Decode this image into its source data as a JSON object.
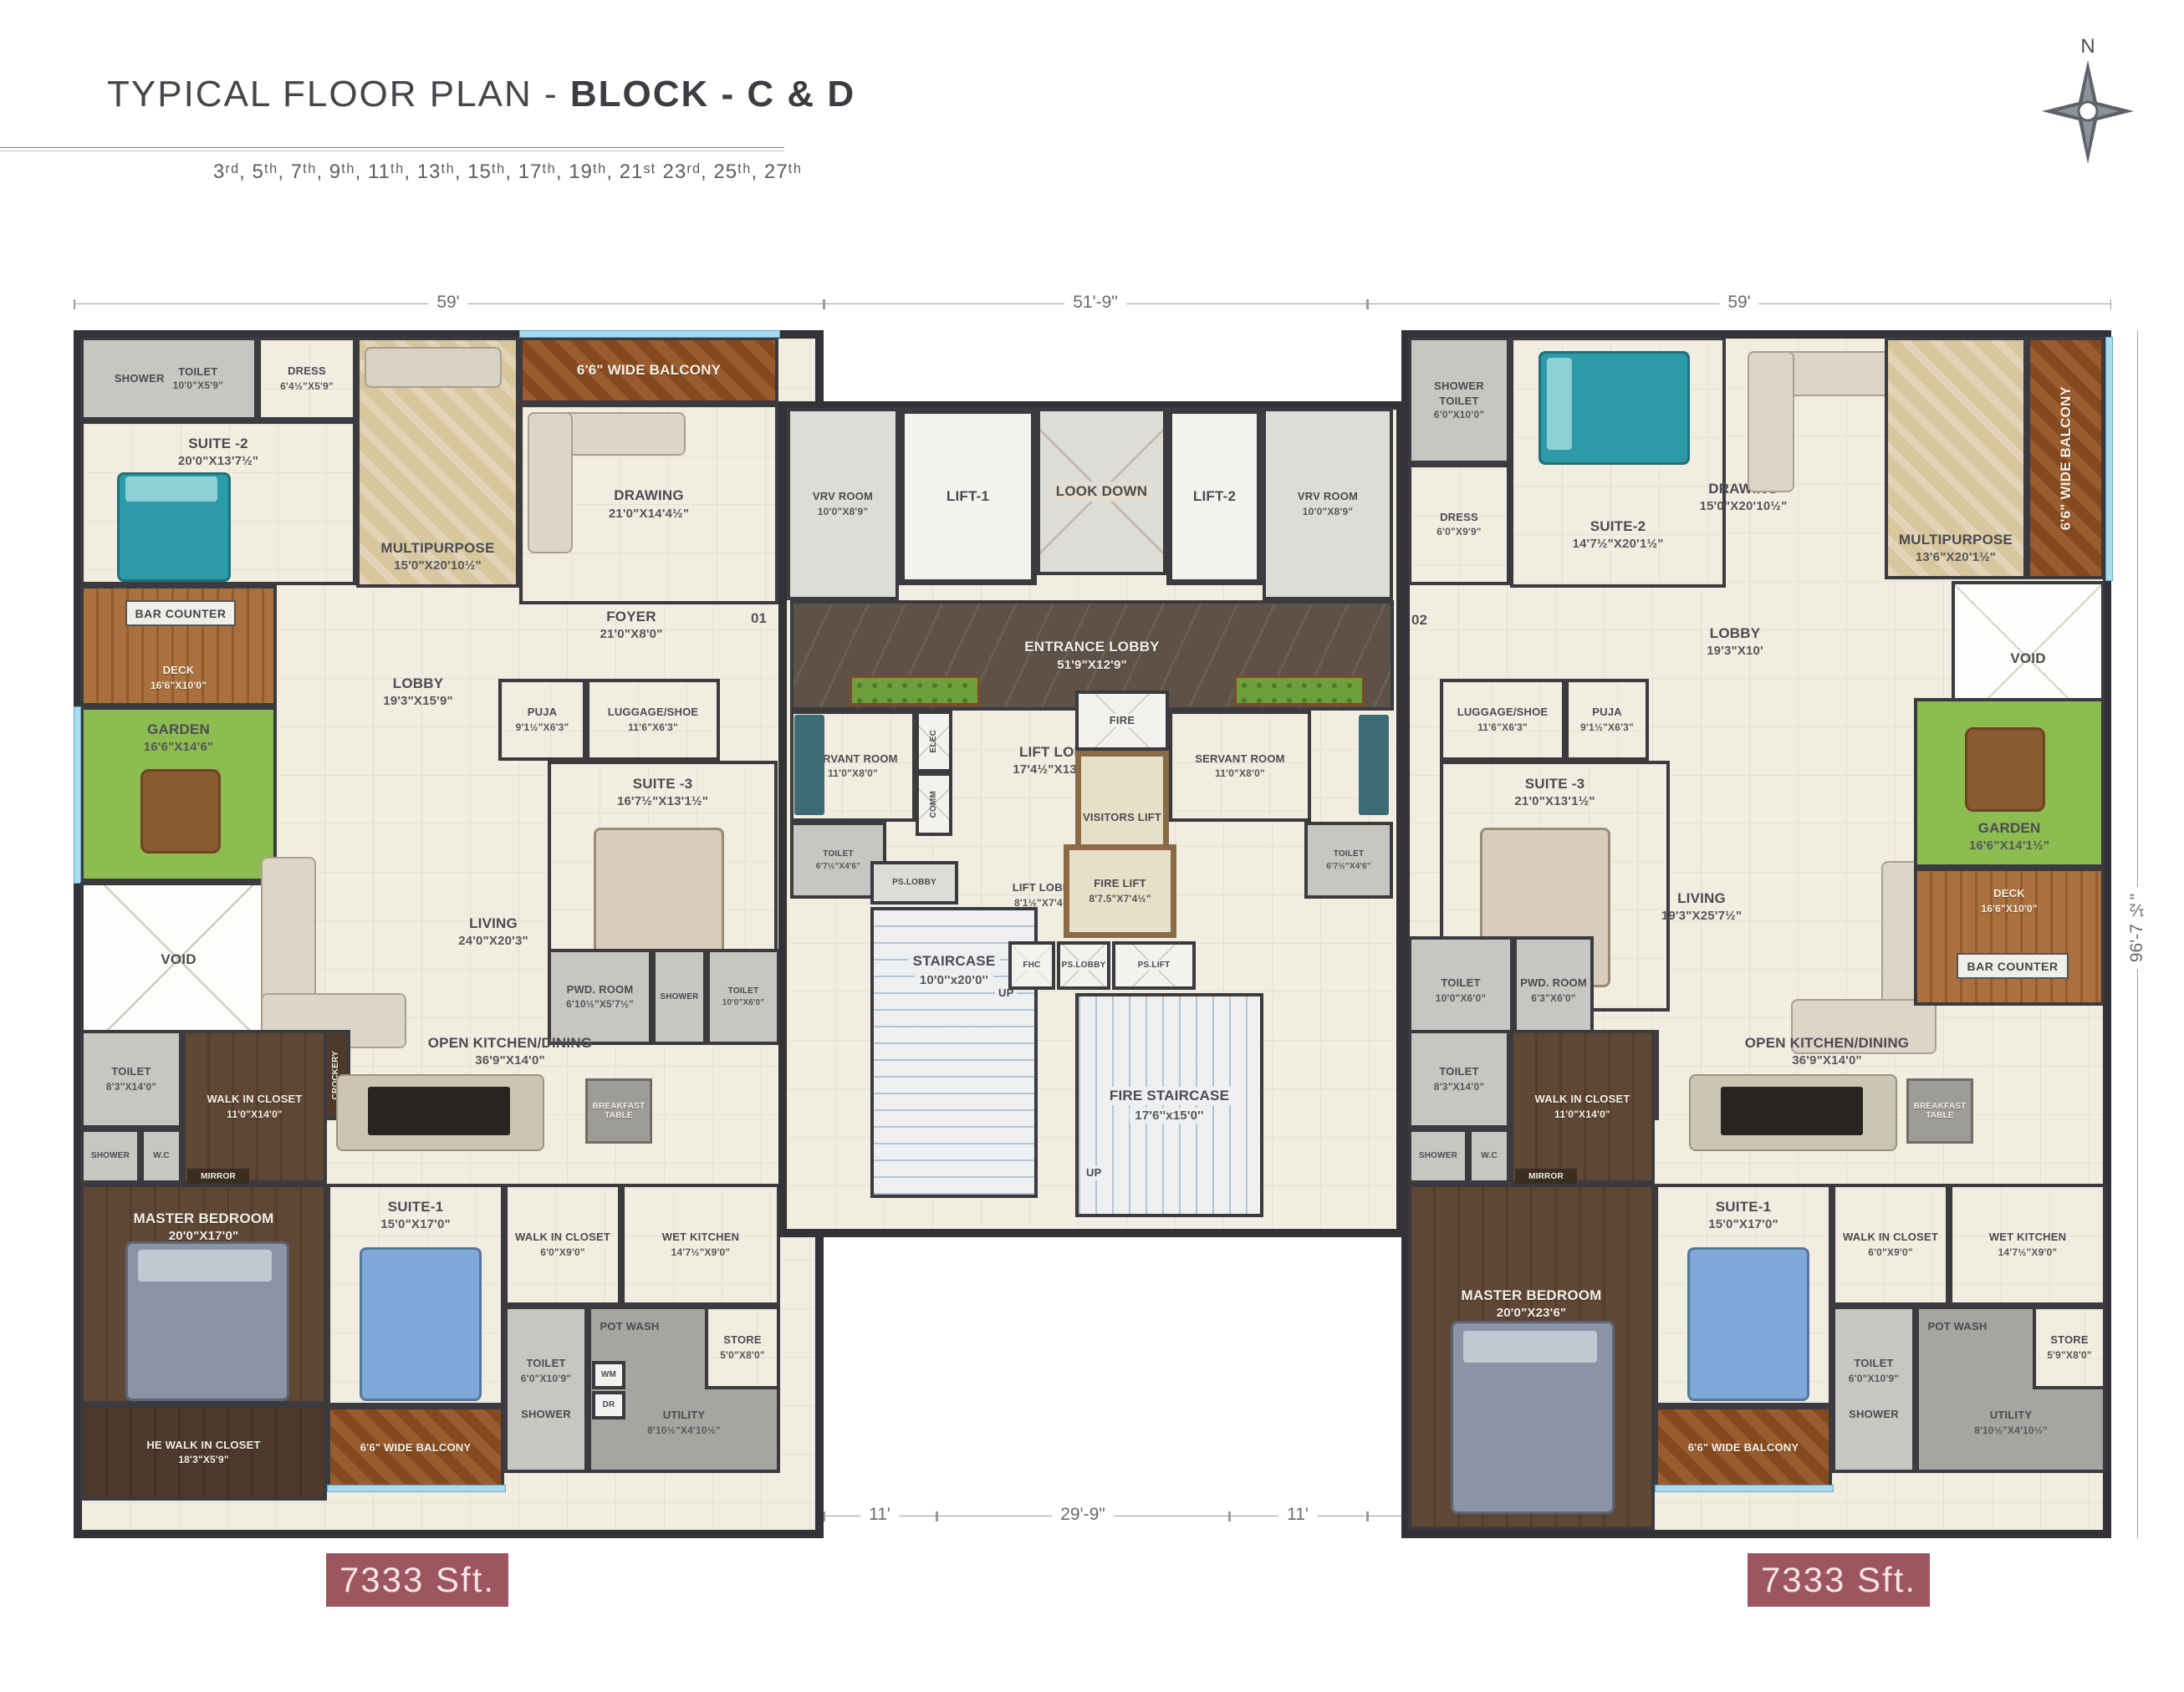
{
  "header": {
    "title_prefix": "TYPICAL FLOOR PLAN - ",
    "title_bold": "BLOCK - C & D",
    "floors": "3ʳᵈ, 5ᵗʰ, 7ᵗʰ, 9ᵗʰ, 11ᵗʰ, 13ᵗʰ, 15ᵗʰ, 17ᵗʰ, 19ᵗʰ, 21ˢᵗ 23ʳᵈ, 25ᵗʰ, 27ᵗʰ",
    "north": "N"
  },
  "watermark": "housiey.com",
  "area_badges": {
    "left": "7333 Sft.",
    "right": "7333 Sft."
  },
  "doors": {
    "left": "01",
    "right": "02"
  },
  "dims": {
    "top_left": "59'",
    "top_center": "51'-9\"",
    "top_right": "59'",
    "bottom_left": "59'",
    "bottom_gap_left": "11'",
    "bottom_center": "29'-9\"",
    "bottom_gap_right": "11'",
    "bottom_right": "59'",
    "right_height": "96'-7 ½\""
  },
  "colors": {
    "wall": "#323237",
    "badge": "#9d5560",
    "grass": "#8dbd50",
    "deck": "#aa713f",
    "balcony": "#9a5c2e",
    "dark_marble": "#5e5148",
    "window": "#a9dbf0",
    "dark_wood": "#5f4736"
  },
  "rooms": {
    "l_shower2": {
      "n": "SHOWER"
    },
    "l_toilet2": {
      "n": "TOILET",
      "d": "10'0\"X5'9\""
    },
    "l_dress": {
      "n": "DRESS",
      "d": "6'4½\"X5'9\""
    },
    "l_suite2": {
      "n": "SUITE -2",
      "d": "20'0\"X13'7½\""
    },
    "l_multi": {
      "n": "MULTIPURPOSE",
      "d": "15'0\"X20'10½\""
    },
    "l_balc_top": {
      "n": "6'6\" WIDE BALCONY"
    },
    "l_drawing": {
      "n": "DRAWING",
      "d": "21'0\"X14'4½\""
    },
    "l_foyer": {
      "n": "FOYER",
      "d": "21'0\"X8'0\""
    },
    "l_bar": {
      "n": "BAR COUNTER"
    },
    "l_deck": {
      "n": "DECK",
      "d": "16'6\"X10'0\""
    },
    "l_garden": {
      "n": "GARDEN",
      "d": "16'6\"X14'6\""
    },
    "l_void": {
      "n": "VOID"
    },
    "l_lobby": {
      "n": "LOBBY",
      "d": "19'3\"X15'9\""
    },
    "l_puja": {
      "n": "PUJA",
      "d": "9'1½\"X6'3\""
    },
    "l_lug": {
      "n": "LUGGAGE/SHOE",
      "d": "11'6\"X6'3\""
    },
    "l_suite3": {
      "n": "SUITE -3",
      "d": "16'7½\"X13'1½\""
    },
    "l_living": {
      "n": "LIVING",
      "d": "24'0\"X20'3\""
    },
    "l_pwd": {
      "n": "PWD. ROOM",
      "d": "6'10½\"X5'7½\""
    },
    "l_shower3": {
      "n": "SHOWER"
    },
    "l_toilet3": {
      "n": "TOILET",
      "d": "10'0\"X6'0\""
    },
    "l_crock": {
      "n": "CROCKERY"
    },
    "l_okd": {
      "n": "OPEN KITCHEN/DINING",
      "d": "36'9\"X14'0\""
    },
    "l_bft": {
      "n": "BREAKFAST TABLE"
    },
    "l_toiletM": {
      "n": "TOILET",
      "d": "8'3\"X14'0\""
    },
    "l_showerM": {
      "n": "SHOWER"
    },
    "l_wc": {
      "n": "W.C"
    },
    "l_mirror": {
      "n": "MIRROR"
    },
    "l_wic": {
      "n": "WALK IN CLOSET",
      "d": "11'0\"X14'0\""
    },
    "l_master": {
      "n": "MASTER BEDROOM",
      "d": "20'0\"X17'0\""
    },
    "l_hewic": {
      "n": "HE WALK IN CLOSET",
      "d": "18'3\"X5'9\""
    },
    "l_suite1": {
      "n": "SUITE-1",
      "d": "15'0\"X17'0\""
    },
    "l_wic1": {
      "n": "WALK IN CLOSET",
      "d": "6'0\"X9'0\""
    },
    "l_wetk": {
      "n": "WET KITCHEN",
      "d": "14'7½\"X9'0\""
    },
    "l_toilet1": {
      "n": "TOILET",
      "d": "6'0\"X10'9\""
    },
    "l_shower1": {
      "n": "SHOWER"
    },
    "l_potwash": {
      "n": "POT WASH"
    },
    "l_wm": {
      "n": "WM"
    },
    "l_dr": {
      "n": "DR"
    },
    "l_utility": {
      "n": "UTILITY",
      "d": "8'10½\"X4'10½\""
    },
    "l_store": {
      "n": "STORE",
      "d": "5'0\"X8'0\""
    },
    "l_balc_bot": {
      "n": "6'6\" WIDE BALCONY"
    },
    "c_vrv_l": {
      "n": "VRV ROOM",
      "d": "10'0\"X8'9\""
    },
    "c_lift1": {
      "n": "LIFT-1"
    },
    "c_lookdown": {
      "n": "LOOK DOWN"
    },
    "c_lift2": {
      "n": "LIFT-2"
    },
    "c_vrv_r": {
      "n": "VRV ROOM",
      "d": "10'0\"X8'9\""
    },
    "c_entr": {
      "n": "ENTRANCE LOBBY",
      "d": "51'9\"X12'9\""
    },
    "c_serv_l": {
      "n": "SERVANT ROOM",
      "d": "11'0\"X8'0\""
    },
    "c_elec": {
      "n": "ELEC"
    },
    "c_comm": {
      "n": "COMM"
    },
    "c_toilet_l": {
      "n": "TOILET",
      "d": "6'7½\"X4'6\""
    },
    "c_liftlobby": {
      "n": "LIFT LOBBY",
      "d": "17'4½\"X13'10½\""
    },
    "c_fire": {
      "n": "FIRE"
    },
    "c_serv_r": {
      "n": "SERVANT ROOM",
      "d": "11'0\"X8'0\""
    },
    "c_vis": {
      "n": "VISITORS LIFT"
    },
    "c_toilet_r": {
      "n": "TOILET",
      "d": "6'7½\"X4'6\""
    },
    "c_pslobby1": {
      "n": "PS.LOBBY"
    },
    "c_liftlobby2": {
      "n": "LIFT LOBBY",
      "d": "8'1½\"X7'4½\""
    },
    "c_firelift": {
      "n": "FIRE LIFT",
      "d": "8'7.5\"X7'4½\""
    },
    "c_stair": {
      "n": "STAIRCASE",
      "d": "10'0''x20'0''"
    },
    "c_up1": {
      "n": "UP"
    },
    "c_up2": {
      "n": "UP"
    },
    "c_fhc": {
      "n": "FHC"
    },
    "c_pslobby2": {
      "n": "PS.LOBBY"
    },
    "c_pslift": {
      "n": "PS.LIFT"
    },
    "c_firestair": {
      "n": "FIRE STAIRCASE",
      "d": "17'6''x15'0''"
    },
    "r_shower2": {
      "n": "SHOWER"
    },
    "r_toilet2": {
      "n": "TOILET",
      "d": "6'0\"X10'0\""
    },
    "r_dress": {
      "n": "DRESS",
      "d": "6'0\"X9'9\""
    },
    "r_suite2": {
      "n": "SUITE-2",
      "d": "14'7½\"X20'1½\""
    },
    "r_drawing": {
      "n": "DRAWING",
      "d": "15'0\"X20'10½\""
    },
    "r_multi": {
      "n": "MULTIPURPOSE",
      "d": "13'6\"X20'1½\""
    },
    "r_balc_side": {
      "n": "6'6\" WIDE BALCONY"
    },
    "r_lobby": {
      "n": "LOBBY",
      "d": "19'3\"X10'"
    },
    "r_void": {
      "n": "VOID"
    },
    "r_lug": {
      "n": "LUGGAGE/SHOE",
      "d": "11'6\"X6'3\""
    },
    "r_puja": {
      "n": "PUJA",
      "d": "9'1½\"X6'3\""
    },
    "r_suite3": {
      "n": "SUITE -3",
      "d": "21'0\"X13'1½\""
    },
    "r_living": {
      "n": "LIVING",
      "d": "19'3\"X25'7½\""
    },
    "r_toilet3": {
      "n": "TOILET",
      "d": "10'0\"X6'0\""
    },
    "r_pwd": {
      "n": "PWD. ROOM",
      "d": "6'3\"X6'0\""
    },
    "r_garden": {
      "n": "GARDEN",
      "d": "16'6\"X14'1½\""
    },
    "r_deck": {
      "n": "DECK",
      "d": "16'6\"X10'0\""
    },
    "r_bar": {
      "n": "BAR COUNTER"
    },
    "r_crock": {
      "n": "CROCKERY"
    },
    "r_okd": {
      "n": "OPEN KITCHEN/DINING",
      "d": "36'9\"X14'0\""
    },
    "r_bft": {
      "n": "BREAKFAST TABLE"
    },
    "r_toiletM": {
      "n": "TOILET",
      "d": "8'3\"X14'0\""
    },
    "r_showerM": {
      "n": "SHOWER"
    },
    "r_wc": {
      "n": "W.C"
    },
    "r_mirror": {
      "n": "MIRROR"
    },
    "r_wic": {
      "n": "WALK IN CLOSET",
      "d": "11'0\"X14'0\""
    },
    "r_master": {
      "n": "MASTER BEDROOM",
      "d": "20'0\"X23'6\""
    },
    "r_suite1": {
      "n": "SUITE-1",
      "d": "15'0\"X17'0\""
    },
    "r_wic1": {
      "n": "WALK IN CLOSET",
      "d": "6'0\"X9'0\""
    },
    "r_wetk": {
      "n": "WET KITCHEN",
      "d": "14'7½\"X9'0\""
    },
    "r_toilet1": {
      "n": "TOILET",
      "d": "6'0\"X10'9\""
    },
    "r_shower1": {
      "n": "SHOWER"
    },
    "r_potwash": {
      "n": "POT WASH"
    },
    "r_utility": {
      "n": "UTILITY",
      "d": "8'10½\"X4'10½\""
    },
    "r_store": {
      "n": "STORE",
      "d": "5'9\"X8'0\""
    },
    "r_balc_bot": {
      "n": "6'6\" WIDE BALCONY"
    }
  }
}
